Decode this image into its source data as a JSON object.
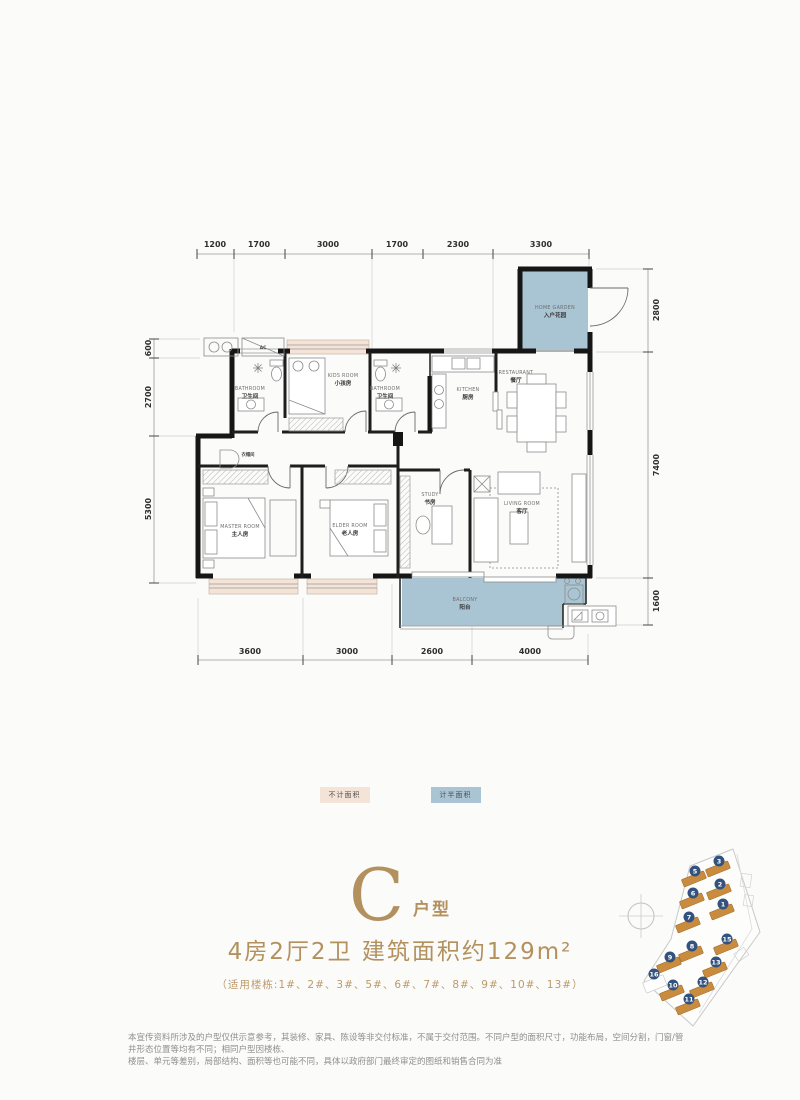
{
  "plan": {
    "dims": {
      "top": [
        "1200",
        "1700",
        "3000",
        "1700",
        "2300",
        "3300"
      ],
      "bottom": [
        "3600",
        "3000",
        "2600",
        "4000"
      ],
      "left": [
        "600",
        "2700",
        "5300"
      ],
      "right": [
        "2800",
        "7400",
        "1600"
      ]
    },
    "rooms": {
      "home_garden": {
        "en": "HOME GARDEN",
        "zh": "入户花园"
      },
      "kids": {
        "en": "KIDS ROOM",
        "zh": "小孩房"
      },
      "bathroom1": {
        "en": "BATHROOM",
        "zh": "卫生间"
      },
      "bathroom2": {
        "en": "BATHROOM",
        "zh": "卫生间"
      },
      "kitchen": {
        "en": "KITCHEN",
        "zh": "厨房"
      },
      "restaurant": {
        "en": "RESTAURANT",
        "zh": "餐厅"
      },
      "master": {
        "en": "MASTER ROOM",
        "zh": "主人房"
      },
      "elder": {
        "en": "ELDER ROOM",
        "zh": "老人房"
      },
      "study": {
        "en": "STUDY",
        "zh": "书房"
      },
      "living": {
        "en": "LIVING ROOM",
        "zh": "客厅"
      },
      "balcony": {
        "en": "BALCONY",
        "zh": "阳台"
      },
      "cloak": {
        "zh": "衣帽间"
      },
      "ac_label": "AC"
    }
  },
  "legend": {
    "excluded": "不计面积",
    "half": "计半面积"
  },
  "title": {
    "letter": "C",
    "suffix": "户型",
    "subtitle": "4房2厅2卫 建筑面积约129m²",
    "note": "（适用楼栋:1#、2#、3#、5#、6#、7#、8#、9#、10#、13#）"
  },
  "sitemap": {
    "buildings": [
      "3",
      "5",
      "2",
      "6",
      "1",
      "7",
      "15",
      "8",
      "9",
      "13",
      "16",
      "10",
      "12",
      "11"
    ]
  },
  "disclaimer": {
    "line1": "本宣传资料所涉及的户型仅供示意参考，其装修、家具、陈设等非交付标准，不属于交付范围。不同户型的面积尺寸，功能布局，空间分割，门窗/管井形态位置等均有不同；相同户型因楼栋、",
    "line2": "楼层、单元等差别，局部结构、面积等也可能不同，具体以政府部门最终审定的图纸和销售合同为准"
  },
  "colors": {
    "accent_gold": "#b3915e",
    "half_area_blue": "#a9c4d3",
    "excluded_area_tan": "#f4e3d7",
    "wall_black": "#161616",
    "sitemap_building_orange": "#c98c3f",
    "sitemap_number_navy": "#33527e"
  }
}
